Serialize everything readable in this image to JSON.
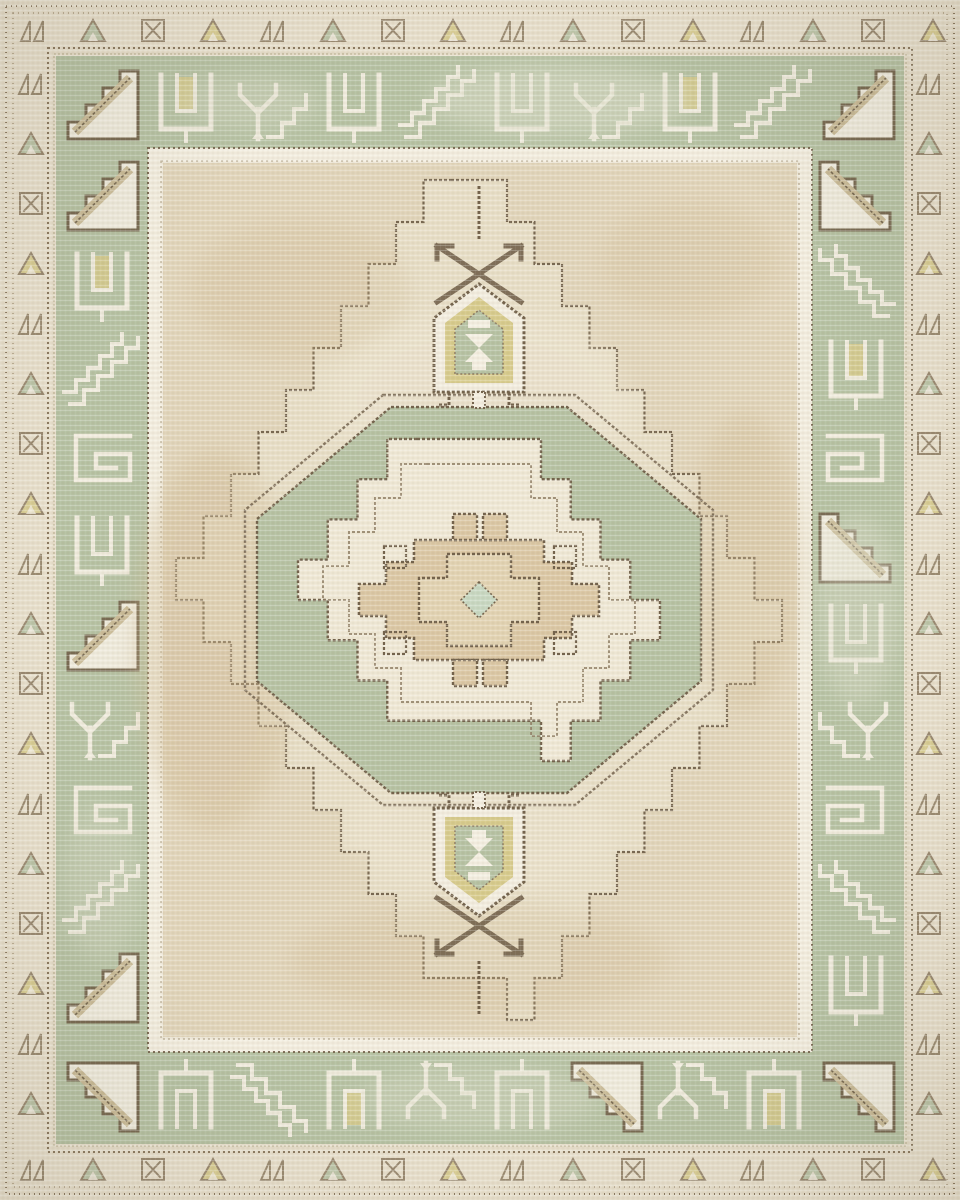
{
  "meta": {
    "title": "Vintage-style Anatolian medallion area rug",
    "description": "Distressed woven area rug: beige field with large stepped lozenge, central green octagon medallion with stepped ivory star and hooked tan gul, shield pendants above and below, wide sage-green border of white geometric animal motifs, and a narrow cream outer border of small triangle motifs."
  },
  "palette": {
    "edge-cream": "#e9e1ce",
    "outer-border-bg": "#ece4d1",
    "outline-brown": "#73634d",
    "outline-brown-soft": "#8d7c63",
    "outline-brown-faint": "#b1a288",
    "band-green": "#b7c3a5",
    "guard-cream": "#f3eee0",
    "field-tan": "#e2d6bc",
    "diamond-cream": "#e9e0c9",
    "motif-white": "#f4efe2",
    "accent-olive": "#d8cc8e",
    "accent-palegreen": "#c9d9c3",
    "medallion-cream": "#f0e9d7",
    "center-tan": "#dcc9a6",
    "center-tan-light": "#e3d4b4",
    "band-tan": "#cdbd9a",
    "wear-cream": "#dfe0cd",
    "wear-tan": "#d2bd97",
    "wear-light": "#f1ead7"
  },
  "outer_border": {
    "cycle": [
      "zigzag",
      "tree-green",
      "hourglass",
      "tree-olive"
    ],
    "rows": [
      {
        "name": "top",
        "axis": "x",
        "fixed": 17,
        "start": 18,
        "step": 60,
        "count": 16
      },
      {
        "name": "bottom",
        "axis": "x",
        "fixed": 1156,
        "start": 18,
        "step": 60,
        "count": 16
      },
      {
        "name": "left",
        "axis": "y",
        "fixed": 16,
        "start": 70,
        "step": 60,
        "count": 18
      },
      {
        "name": "right",
        "axis": "y",
        "fixed": 914,
        "start": 70,
        "step": 60,
        "count": 18
      }
    ]
  },
  "green_band": {
    "sides": [
      {
        "name": "top",
        "axis": "x",
        "fixed": 61,
        "start": 60,
        "step": 84,
        "flip": "",
        "seq": [
          "diag-filled",
          "u-olive",
          "y-diag",
          "u",
          "diag-outline",
          "u",
          "y-diag",
          "u-olive",
          "diag-outline",
          "diag-filled"
        ]
      },
      {
        "name": "bottom",
        "axis": "x",
        "fixed": 1057,
        "start": 60,
        "step": 84,
        "flip": "y",
        "seq": [
          "diag-filled",
          "u",
          "diag-outline",
          "u-olive",
          "y-diag",
          "u",
          "diag-filled",
          "y-diag",
          "u-olive",
          "diag-filled"
        ]
      },
      {
        "name": "left",
        "axis": "y",
        "fixed": 60,
        "start": 152,
        "step": 88,
        "flip": "",
        "seq": [
          "diag-filled",
          "u-olive",
          "diag-outline",
          "rect-spiral",
          "u",
          "diag-filled",
          "y-diag",
          "rect-spiral",
          "diag-outline",
          "diag-filled"
        ]
      },
      {
        "name": "right",
        "axis": "y",
        "fixed": 814,
        "start": 152,
        "step": 88,
        "flip": "x",
        "seq": [
          "diag-filled",
          "diag-outline",
          "u-olive",
          "rect-spiral",
          "diag-filled",
          "u",
          "y-diag",
          "rect-spiral",
          "diag-outline",
          "u"
        ]
      }
    ]
  },
  "medallion_geometry": {
    "field_diamond": {
      "cx": 479,
      "cy": 600,
      "rx": 303,
      "ry": 420,
      "steps": 10,
      "apex_half": 28
    },
    "star_outer": {
      "cx": 479,
      "cy": 600,
      "rx": 181,
      "ry": 161,
      "steps": 4,
      "apex_half": 62
    },
    "star_inner": {
      "cx": 479,
      "cy": 600,
      "rx": 156,
      "ry": 136,
      "steps": 4,
      "apex_half": 52
    }
  },
  "wear": [
    {
      "x": 560,
      "y": 100,
      "rx": 130,
      "ry": 36,
      "color": "wear-cream",
      "o": 0.5
    },
    {
      "x": 250,
      "y": 102,
      "rx": 70,
      "ry": 28,
      "color": "wear-cream",
      "o": 0.35
    },
    {
      "x": 858,
      "y": 610,
      "rx": 42,
      "ry": 95,
      "color": "wear-cream",
      "o": 0.4
    },
    {
      "x": 102,
      "y": 880,
      "rx": 40,
      "ry": 80,
      "color": "wear-cream",
      "o": 0.3
    },
    {
      "x": 480,
      "y": 1098,
      "rx": 120,
      "ry": 34,
      "color": "wear-cream",
      "o": 0.35
    },
    {
      "x": 215,
      "y": 640,
      "rx": 80,
      "ry": 190,
      "color": "wear-tan",
      "o": 0.4
    },
    {
      "x": 745,
      "y": 560,
      "rx": 55,
      "ry": 150,
      "color": "wear-tan",
      "o": 0.35
    },
    {
      "x": 480,
      "y": 960,
      "rx": 190,
      "ry": 55,
      "color": "wear-tan",
      "o": 0.28
    },
    {
      "x": 300,
      "y": 290,
      "rx": 110,
      "ry": 70,
      "color": "wear-tan",
      "o": 0.28
    },
    {
      "x": 690,
      "y": 260,
      "rx": 90,
      "ry": 60,
      "color": "wear-tan",
      "o": 0.25
    },
    {
      "x": 480,
      "y": 400,
      "rx": 150,
      "ry": 90,
      "color": "wear-light",
      "o": 0.35
    },
    {
      "x": 480,
      "y": 830,
      "rx": 130,
      "ry": 60,
      "color": "wear-light",
      "o": 0.3
    }
  ]
}
